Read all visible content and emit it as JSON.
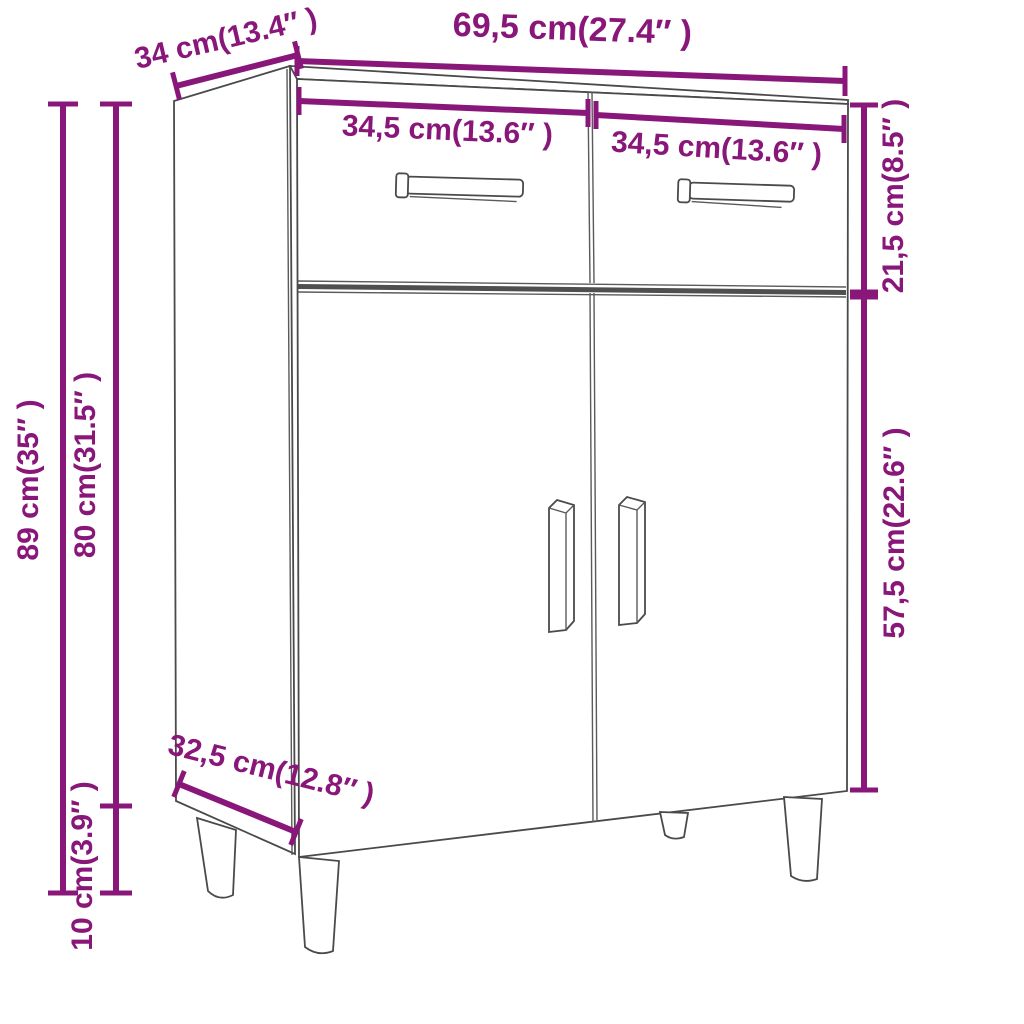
{
  "diagram": {
    "kind": "product-dimension-diagram",
    "subject": "sideboard cabinet with two drawers, two doors and four tapered legs",
    "background_color": "#ffffff",
    "accent_color": "#89177A",
    "outline_color": "#4a4a4a"
  },
  "labels": {
    "width_top": "69,5 cm(27.4″ )",
    "depth_top": "34 cm(13.4″ )",
    "drawer_width_left": "34,5 cm(13.6″ )",
    "drawer_width_right": "34,5 cm(13.6″ )",
    "drawer_section_height": "21,5 cm(8.5″ )",
    "door_section_height": "57,5 cm(22.6″ )",
    "total_height": "89 cm(35″ )",
    "body_height": "80 cm(31.5″ )",
    "leg_height": "10 cm(3.9″ )",
    "depth_bottom": "32,5 cm(12.8″ )"
  },
  "measurements": [
    {
      "name": "overall width",
      "cm": "69,5",
      "inch": "27.4"
    },
    {
      "name": "top depth",
      "cm": "34",
      "inch": "13.4"
    },
    {
      "name": "drawer width left",
      "cm": "34,5",
      "inch": "13.6"
    },
    {
      "name": "drawer width right",
      "cm": "34,5",
      "inch": "13.6"
    },
    {
      "name": "drawer section height",
      "cm": "21,5",
      "inch": "8.5"
    },
    {
      "name": "door section height",
      "cm": "57,5",
      "inch": "22.6"
    },
    {
      "name": "overall height",
      "cm": "89",
      "inch": "35"
    },
    {
      "name": "body height",
      "cm": "80",
      "inch": "31.5"
    },
    {
      "name": "leg height",
      "cm": "10",
      "inch": "3.9"
    },
    {
      "name": "bottom depth",
      "cm": "32,5",
      "inch": "12.8"
    }
  ]
}
